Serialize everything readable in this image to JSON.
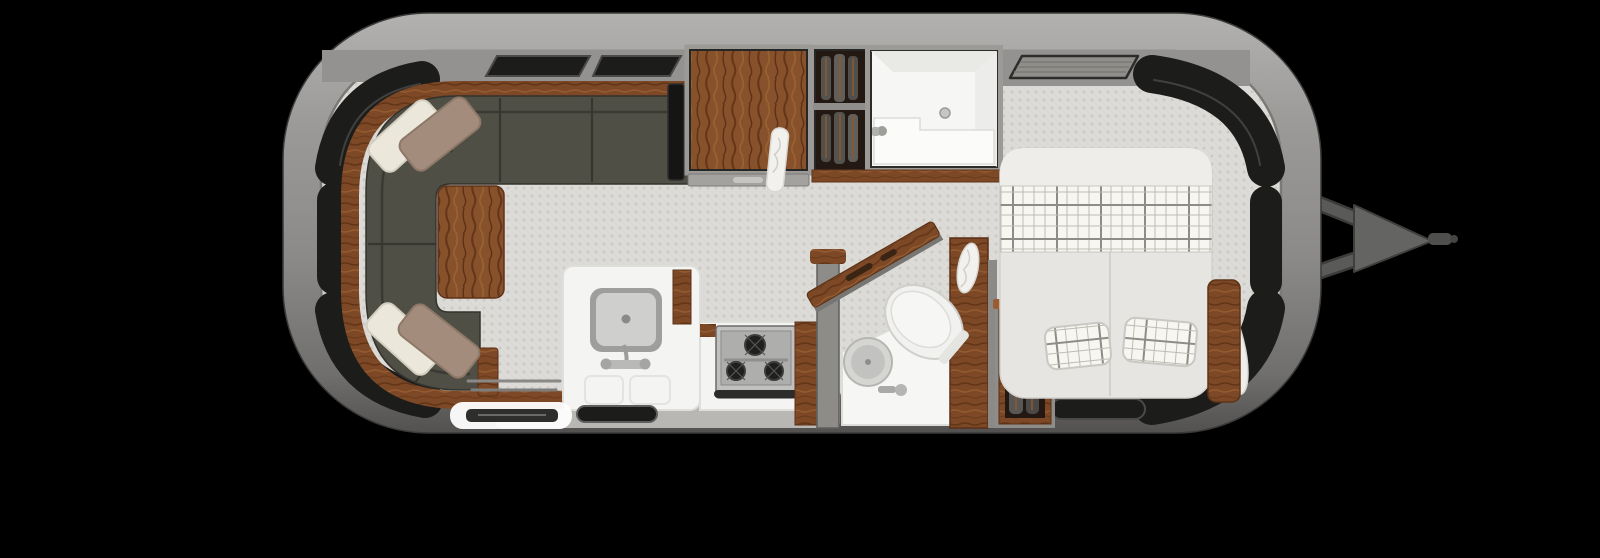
{
  "scene": {
    "kind": "travel-trailer-floor-plan",
    "view": "top-down interior cutaway",
    "background": "#000000"
  },
  "colors": {
    "background": "#000000",
    "shell_top": "#b2b1af",
    "shell_upper": "#9a9997",
    "shell_mid": "#8b8a88",
    "shell_lower": "#706f6d",
    "shell_bottom": "#525150",
    "shell_outline": "#2e2e2c",
    "wall_band": "#939290",
    "floor_base": "#dcdbd7",
    "floor_dot": "#cbcac5",
    "window_glass": "#1c1c1a",
    "window_frame": "#454543",
    "sofa_body": "#504f45",
    "sofa_backline": "#3a3933",
    "sofa_seam": "#36352e",
    "wood_base": "#7c4826",
    "wood_dark": "#633517",
    "wood_light": "#965c31",
    "cabinet_wood": "#87512b",
    "pillow_cream": "#ebe7da",
    "pillow_taupe": "#a38c7c",
    "counter_white": "#f4f4f2",
    "counter_edge": "#d9d8d5",
    "sink_basin": "#cfcfcd",
    "sink_rim": "#9e9e9c",
    "stove_body": "#c0c0be",
    "stove_inner": "#aeaeac",
    "burner_dark": "#1f1f1d",
    "bath_white": "#f6f6f4",
    "bed_duvet": "#e6e5e1",
    "bed_fold": "#eeedea",
    "plaid_bg": "#f7f6f1",
    "plaid_line": "#bdbcb4",
    "plaid_bold": "#8e8d85",
    "closet_interior": "#231812",
    "garment_gray": "#55534f",
    "apron_gray": "#b8b7b4",
    "step_white": "#ffffff",
    "step_inset": "#2e2e2c",
    "hitch_bar": "#5a5a58",
    "hitch_plate": "#646462",
    "hitch_tongue": "#4f4f4d",
    "vent_fill": "#8f8e8a",
    "tv_black": "#151513",
    "ledge_gray": "#a3a29e",
    "divider_gray": "#8d8c89",
    "towel_white": "#f2f1ee"
  },
  "layout": {
    "rooms": [
      {
        "name": "rear-lounge",
        "fixtures": [
          "u-shaped-sofa",
          "throw-pillows-top",
          "throw-pillows-bottom",
          "wood-table",
          "wood-trim-shelf",
          "tv-panel"
        ]
      },
      {
        "name": "midship-storage",
        "fixtures": [
          "overhead-wardrobe-cabinet",
          "hanging-closet",
          "towel-hook",
          "storage-ledge",
          "wood-shelf-band"
        ]
      },
      {
        "name": "wet-bath-shower",
        "fixtures": [
          "shower-stall",
          "shower-bench",
          "floor-drain",
          "shower-head"
        ]
      },
      {
        "name": "galley",
        "fixtures": [
          "kitchen-sink",
          "faucet",
          "drawer-fronts",
          "three-burner-stove",
          "pantry-cabinet",
          "entry-step",
          "entry-door-seal"
        ]
      },
      {
        "name": "bathroom",
        "fixtures": [
          "toilet",
          "vanity-counter",
          "round-vanity-sink",
          "angled-partition",
          "wood-cabinet-wall",
          "hand-towel"
        ]
      },
      {
        "name": "front-bedroom",
        "fixtures": [
          "bed",
          "plaid-blanket-band",
          "plaid-pillow-left",
          "plaid-pillow-right",
          "bolster-pillow",
          "nightstand",
          "clothes-wardrobe",
          "roof-vent",
          "bottom-window"
        ]
      }
    ],
    "shell_features": [
      "curved-corner-windows",
      "side-windows",
      "top-windows",
      "hitch-a-frame",
      "hitch-coupler",
      "hitch-tongue"
    ]
  }
}
